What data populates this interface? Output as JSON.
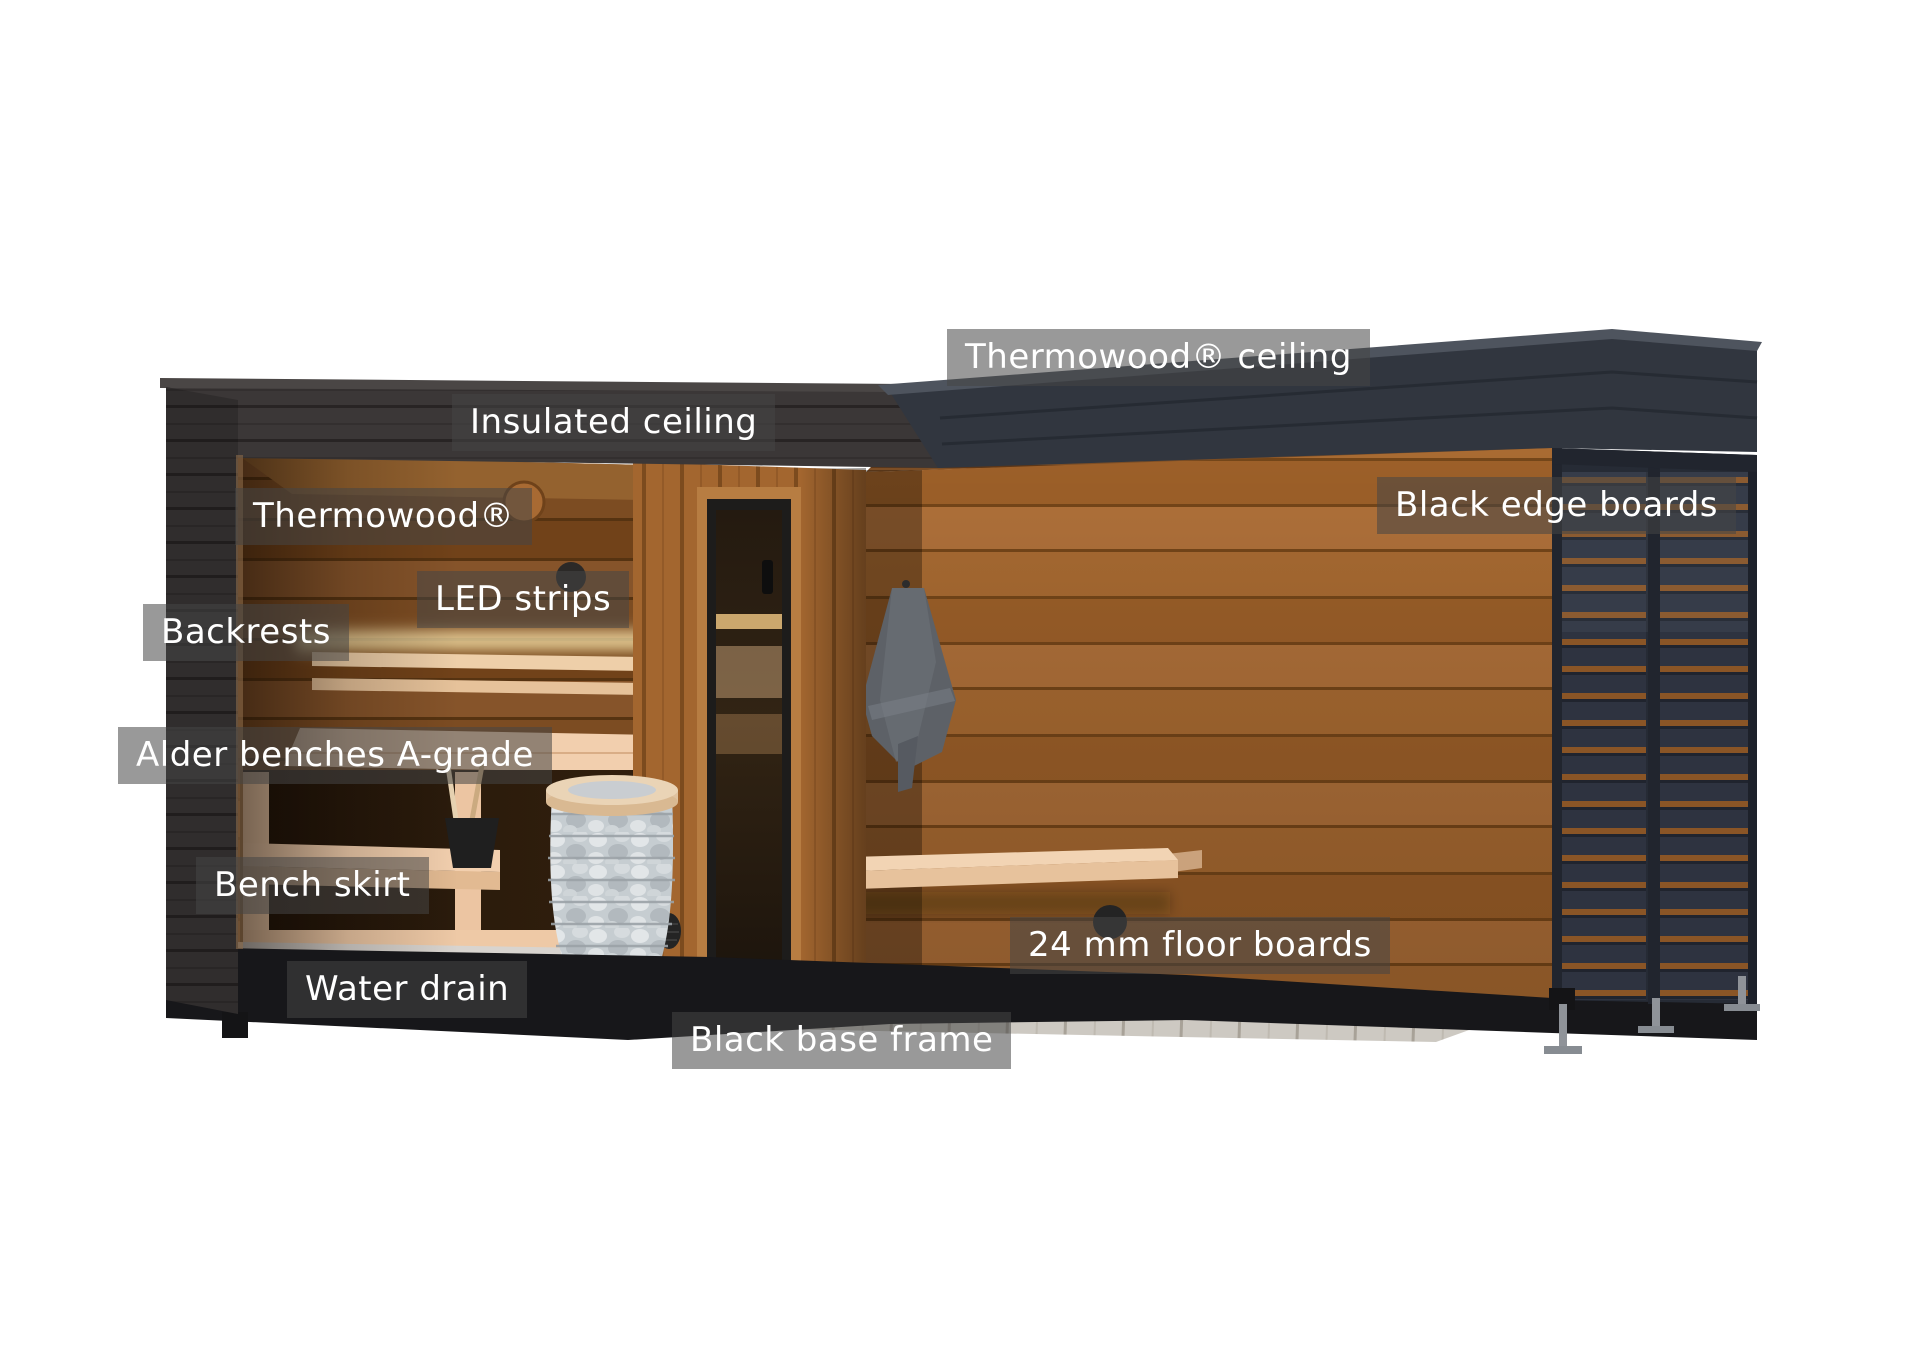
{
  "figure": {
    "type": "annotated-product-cutaway",
    "subject": "Outdoor sauna cutaway with labeled components",
    "background": "#ffffff"
  },
  "labels": [
    {
      "id": "thermowood-ceiling",
      "text": "Thermowood® ceiling"
    },
    {
      "id": "insulated-ceiling",
      "text": "Insulated ceiling"
    },
    {
      "id": "thermowood",
      "text": "Thermowood®"
    },
    {
      "id": "black-edge-boards",
      "text": "Black edge boards"
    },
    {
      "id": "led-strips",
      "text": "LED strips"
    },
    {
      "id": "backrests",
      "text": "Backrests"
    },
    {
      "id": "alder-benches",
      "text": "Alder benches A-grade"
    },
    {
      "id": "bench-skirt",
      "text": "Bench skirt"
    },
    {
      "id": "water-drain",
      "text": "Water drain"
    },
    {
      "id": "floor-boards",
      "text": "24 mm floor boards"
    },
    {
      "id": "black-base-frame",
      "text": "Black base frame"
    }
  ],
  "palette": {
    "label_background": "rgba(70,70,70,0.55)",
    "label_text": "#ffffff",
    "roof_black": "#3b3737",
    "fascia_navy": "#31363f",
    "terrace_wood": "#a96b32",
    "interior_wood": "#7c4c22",
    "bench_alder": "#f2cfae",
    "led_glow": "#ffecb4",
    "heater_stones": "#c6cdd1",
    "deck_gray": "#cdc9c2",
    "base_black": "#17171a",
    "towel_gray": "#5d6167"
  }
}
